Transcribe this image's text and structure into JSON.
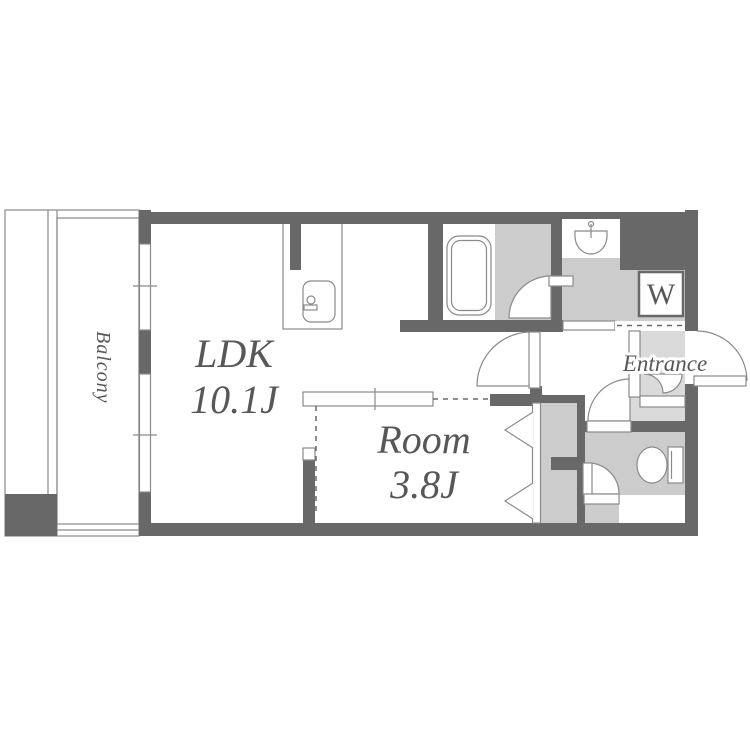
{
  "floorplan": {
    "rooms": {
      "balcony": {
        "label": "Balcony"
      },
      "ldk": {
        "label": "LDK",
        "size": "10.1J"
      },
      "room": {
        "label": "Room",
        "size": "3.8J"
      },
      "entrance": {
        "label": "Entrance"
      },
      "washer": {
        "label": "W"
      }
    },
    "colors": {
      "bg": "#ffffff",
      "wall": "#686868",
      "floor": "#cccccc",
      "entrance_floor": "#dadada",
      "line": "#8a8a8a",
      "text": "#575757"
    }
  }
}
